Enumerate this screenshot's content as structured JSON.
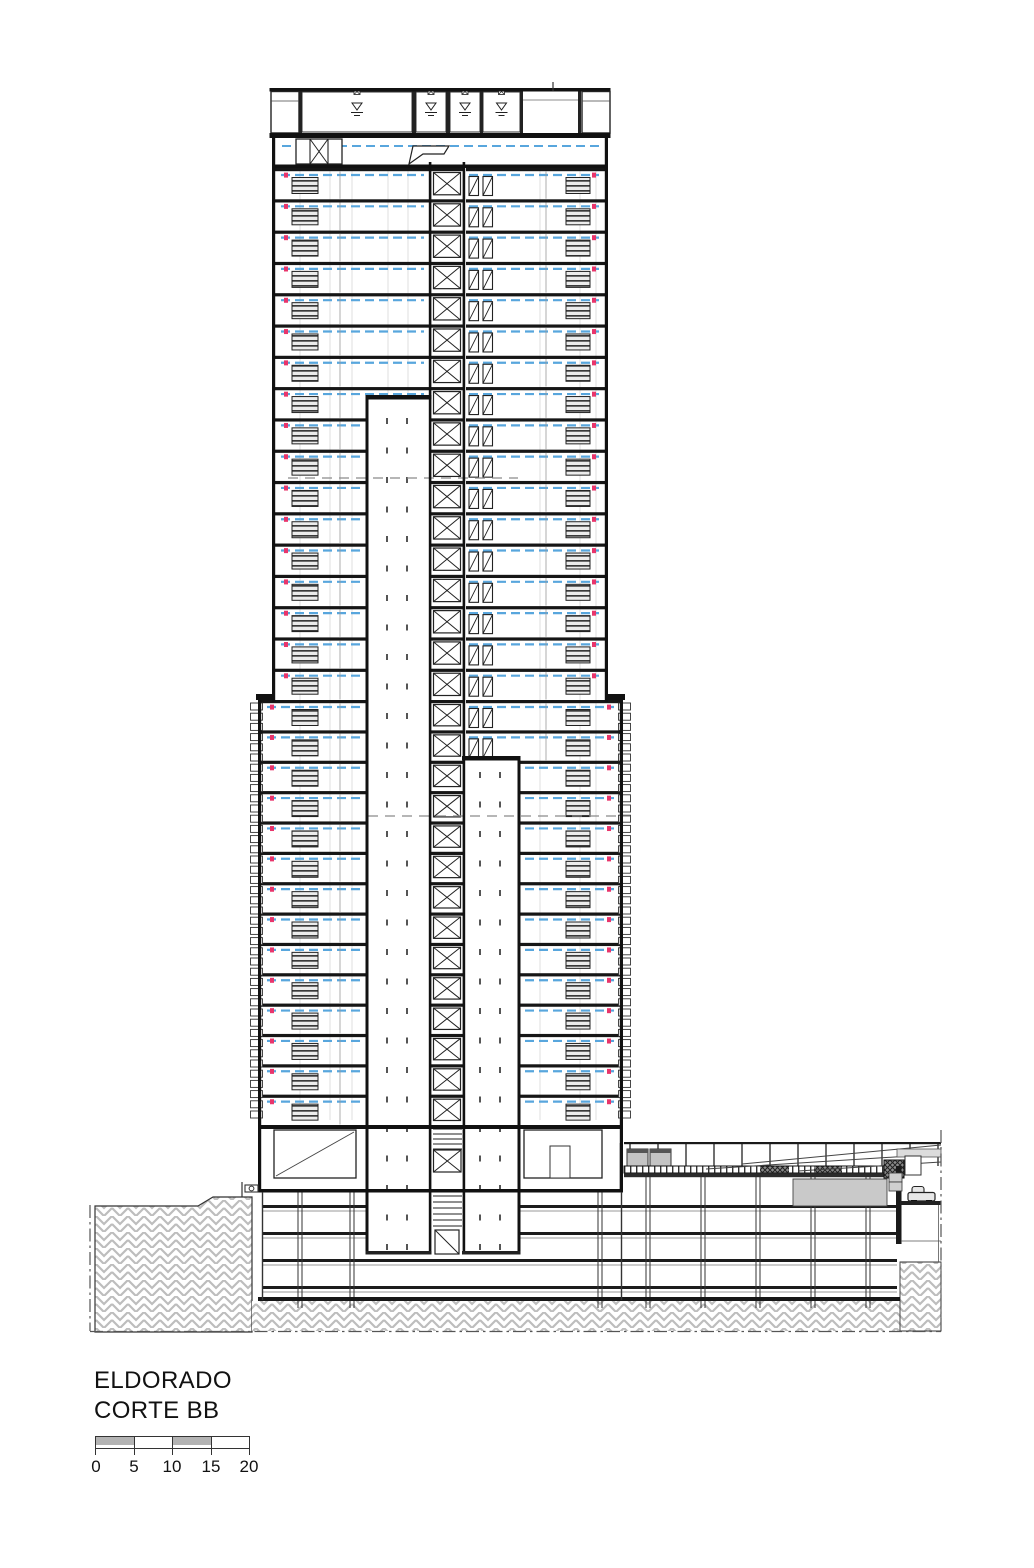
{
  "title_block": {
    "project": "ELDORADO",
    "drawing": "CORTE BB"
  },
  "scale_bar": {
    "tick_labels": [
      "0",
      "5",
      "10",
      "15",
      "20"
    ]
  },
  "drawing": {
    "description": "building cross section",
    "colors": {
      "line": "#1a1a1a",
      "ceiling_dashed": "#58a6dd",
      "level_marker": "#e8356b",
      "ground_hatch": "#bdbdbd",
      "gray_fill": "#c9c9c9"
    },
    "tower": {
      "upper_floors": 17,
      "lower_floors": 14,
      "basement_levels": 4,
      "water_tanks": 4
    }
  }
}
